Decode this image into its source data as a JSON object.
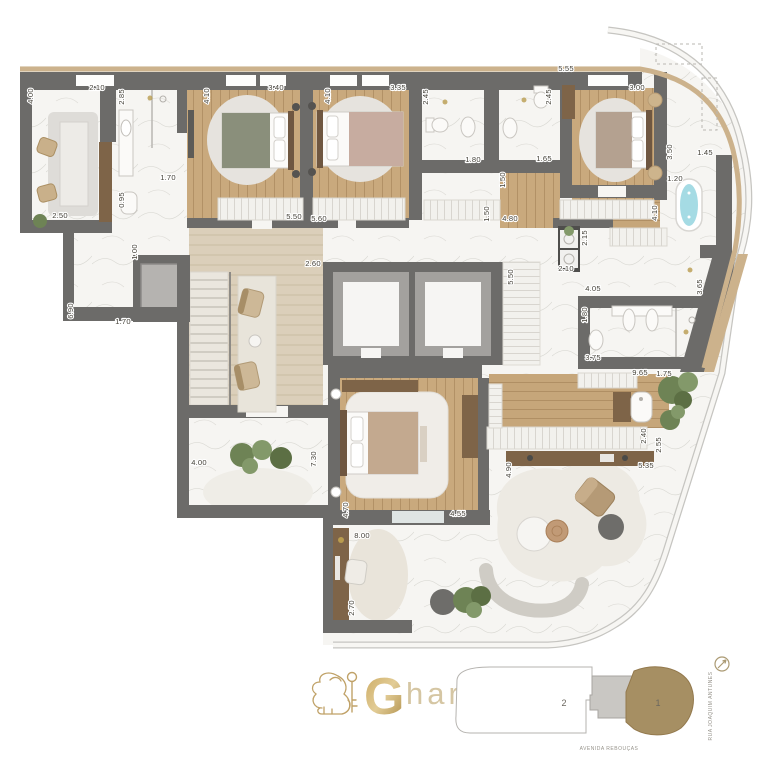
{
  "logo": {
    "g": "G",
    "rest": "har"
  },
  "site_plan": {
    "unit_1": "1",
    "unit_2": "2",
    "street_bottom": "AVENIDA REBOUÇAS",
    "street_right": "RUA JOAQUIM ANTUNES"
  },
  "colors": {
    "wall": "#6c6b69",
    "wood": "#c9a97d",
    "wood_dark": "#7e6448",
    "wood_light": "#dbcfba",
    "marble": "#f6f5f2",
    "shell_edge": "#c6c5c1",
    "gold_deck": "#ccb28c",
    "water": "#a5dbe4",
    "plant_green": "#6e8355",
    "label_text": "#454239",
    "logo_gold": "#c0a268",
    "site_tan": "#a68f63"
  },
  "dimensions": [
    {
      "t": "4.00",
      "x": 33,
      "y": 96,
      "v": 1
    },
    {
      "t": "2.10",
      "x": 97,
      "y": 90
    },
    {
      "t": "2.85",
      "x": 124,
      "y": 97,
      "v": 1
    },
    {
      "t": "4.10",
      "x": 209,
      "y": 96,
      "v": 1
    },
    {
      "t": "3.40",
      "x": 276,
      "y": 90
    },
    {
      "t": "4.10",
      "x": 330,
      "y": 96,
      "v": 1
    },
    {
      "t": "3.35",
      "x": 398,
      "y": 90
    },
    {
      "t": "2.45",
      "x": 428,
      "y": 97,
      "v": 1
    },
    {
      "t": "2.45",
      "x": 551,
      "y": 97,
      "v": 1
    },
    {
      "t": "5.55",
      "x": 566,
      "y": 71
    },
    {
      "t": "3.00",
      "x": 637,
      "y": 90
    },
    {
      "t": "1.70",
      "x": 168,
      "y": 180
    },
    {
      "t": "0.95",
      "x": 124,
      "y": 200,
      "v": 1
    },
    {
      "t": "2.50",
      "x": 60,
      "y": 218
    },
    {
      "t": "5.50",
      "x": 294,
      "y": 219
    },
    {
      "t": "5.60",
      "x": 319,
      "y": 221
    },
    {
      "t": "1.80",
      "x": 473,
      "y": 162
    },
    {
      "t": "1.65",
      "x": 544,
      "y": 161
    },
    {
      "t": "1.50",
      "x": 505,
      "y": 180,
      "v": 1
    },
    {
      "t": "1.50",
      "x": 489,
      "y": 214,
      "v": 1
    },
    {
      "t": "4.80",
      "x": 510,
      "y": 221
    },
    {
      "t": "4.10",
      "x": 657,
      "y": 213,
      "v": 1
    },
    {
      "t": "3.50",
      "x": 672,
      "y": 152,
      "v": 1
    },
    {
      "t": "1.45",
      "x": 705,
      "y": 155
    },
    {
      "t": "1.20",
      "x": 675,
      "y": 181
    },
    {
      "t": "1.00",
      "x": 137,
      "y": 252,
      "v": 1
    },
    {
      "t": "6.90",
      "x": 73,
      "y": 311,
      "v": 1
    },
    {
      "t": "1.70",
      "x": 123,
      "y": 324
    },
    {
      "t": "2.60",
      "x": 313,
      "y": 266
    },
    {
      "t": "5.50",
      "x": 513,
      "y": 277,
      "v": 1
    },
    {
      "t": "2.15",
      "x": 587,
      "y": 238,
      "v": 1
    },
    {
      "t": "2.10",
      "x": 566,
      "y": 271
    },
    {
      "t": "4.05",
      "x": 593,
      "y": 291
    },
    {
      "t": "1.80",
      "x": 587,
      "y": 315,
      "v": 1
    },
    {
      "t": "3.65",
      "x": 702,
      "y": 287,
      "v": 1
    },
    {
      "t": "3.75",
      "x": 593,
      "y": 360
    },
    {
      "t": "9.65",
      "x": 640,
      "y": 375
    },
    {
      "t": "1.75",
      "x": 664,
      "y": 376
    },
    {
      "t": "4.00",
      "x": 199,
      "y": 465
    },
    {
      "t": "7.30",
      "x": 316,
      "y": 459,
      "v": 1
    },
    {
      "t": "4.70",
      "x": 348,
      "y": 510,
      "v": 1
    },
    {
      "t": "4.55",
      "x": 458,
      "y": 516
    },
    {
      "t": "8.00",
      "x": 362,
      "y": 538
    },
    {
      "t": "2.70",
      "x": 354,
      "y": 608,
      "v": 1
    },
    {
      "t": "4.90",
      "x": 511,
      "y": 470,
      "v": 1
    },
    {
      "t": "2.40",
      "x": 646,
      "y": 436,
      "v": 1
    },
    {
      "t": "2.55",
      "x": 661,
      "y": 445,
      "v": 1
    },
    {
      "t": "5.35",
      "x": 646,
      "y": 468
    }
  ]
}
